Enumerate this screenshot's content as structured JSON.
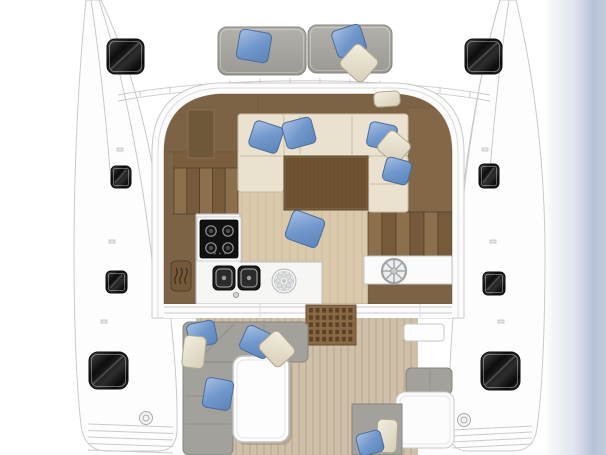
{
  "image": {
    "kind": "catamaran-deck-floor-plan",
    "view": "top-down",
    "visible_text": "none"
  },
  "palette": {
    "bg": "#ffffff",
    "line": "#c7cacd",
    "line2": "#d9dbdd",
    "hull": "#fdfdfe",
    "floor": "#dbc9ab",
    "floor-line": "#b9a888",
    "teak": "#cec0a9",
    "teak-line": "#b2a186",
    "wood": "#7d6345",
    "wood-deep": "#6f5739",
    "wood-edge": "#5f4a33",
    "table-wood": "#6f5333",
    "cream": "#eae2cf",
    "cream-line": "#c6bda3",
    "sofa-gray": "#a3a19c",
    "sofa-edge": "#87857f",
    "pad-gray": "#a9a7a2",
    "counter": "#f6f6f4",
    "counter-edge": "#b9bcbe",
    "pillow-blue": "#7da1d4",
    "pillow-cream": "#e9e3d2",
    "water-edge": "#b6c1d7",
    "hatch-dark": "#0d0d0d"
  },
  "foredeck": {
    "tick_count": 12,
    "sunpads": [
      {
        "x": 218,
        "y": 27,
        "w": 88,
        "h": 48
      },
      {
        "x": 308,
        "y": 25,
        "w": 84,
        "h": 48
      }
    ]
  },
  "deck_hatches": [
    {
      "x": 107,
      "y": 39,
      "w": 37,
      "h": 35,
      "r": 8
    },
    {
      "x": 111,
      "y": 166,
      "w": 20,
      "h": 22,
      "r": 5
    },
    {
      "x": 106,
      "y": 271,
      "w": 21,
      "h": 22,
      "r": 5
    },
    {
      "x": 89,
      "y": 352,
      "w": 39,
      "h": 37,
      "r": 9
    },
    {
      "x": 465,
      "y": 39,
      "w": 37,
      "h": 35,
      "r": 8
    },
    {
      "x": 479,
      "y": 164,
      "w": 20,
      "h": 24,
      "r": 5
    },
    {
      "x": 483,
      "y": 272,
      "w": 22,
      "h": 23,
      "r": 5
    },
    {
      "x": 481,
      "y": 352,
      "w": 39,
      "h": 38,
      "r": 9
    }
  ],
  "pillows": [
    {
      "cx": 254,
      "cy": 46,
      "w": 32,
      "h": 30,
      "rot": 10,
      "color": "blue"
    },
    {
      "cx": 349,
      "cy": 41,
      "w": 30,
      "h": 28,
      "rot": -18,
      "color": "blue"
    },
    {
      "cx": 359,
      "cy": 63,
      "w": 30,
      "h": 29,
      "rot": 42,
      "color": "cream"
    },
    {
      "cx": 266,
      "cy": 137,
      "w": 30,
      "h": 27,
      "rot": 18,
      "color": "blue"
    },
    {
      "cx": 299,
      "cy": 133,
      "w": 30,
      "h": 27,
      "rot": -15,
      "color": "blue"
    },
    {
      "cx": 387,
      "cy": 99,
      "w": 26,
      "h": 15,
      "rot": -4,
      "color": "cream"
    },
    {
      "cx": 382,
      "cy": 136,
      "w": 28,
      "h": 25,
      "rot": 12,
      "color": "blue"
    },
    {
      "cx": 394,
      "cy": 147,
      "w": 27,
      "h": 25,
      "rot": 40,
      "color": "cream"
    },
    {
      "cx": 397,
      "cy": 171,
      "w": 26,
      "h": 24,
      "rot": 15,
      "color": "blue"
    },
    {
      "cx": 305,
      "cy": 229,
      "w": 34,
      "h": 30,
      "rot": 20,
      "color": "blue"
    },
    {
      "cx": 202,
      "cy": 334,
      "w": 28,
      "h": 24,
      "rot": -12,
      "color": "blue"
    },
    {
      "cx": 194,
      "cy": 352,
      "w": 22,
      "h": 32,
      "rot": 6,
      "color": "cream"
    },
    {
      "cx": 257,
      "cy": 342,
      "w": 30,
      "h": 26,
      "rot": 25,
      "color": "blue"
    },
    {
      "cx": 277,
      "cy": 349,
      "w": 30,
      "h": 26,
      "rot": 48,
      "color": "cream"
    },
    {
      "cx": 218,
      "cy": 394,
      "w": 28,
      "h": 30,
      "rot": 10,
      "color": "blue"
    },
    {
      "cx": 387,
      "cy": 436,
      "w": 20,
      "h": 33,
      "rot": 3,
      "color": "cream"
    },
    {
      "cx": 370,
      "cy": 443,
      "w": 25,
      "h": 22,
      "rot": -15,
      "color": "blue"
    }
  ],
  "stairs": [
    {
      "x": 174,
      "y": 168,
      "w": 64,
      "h": 46,
      "steps": 5
    },
    {
      "x": 368,
      "y": 212,
      "w": 84,
      "h": 44,
      "steps": 6
    }
  ],
  "saloon_table": {
    "x": 284,
    "y": 156,
    "w": 84,
    "h": 54,
    "grain_spacing": 4
  },
  "cockpit_table": {
    "x": 233,
    "y": 356,
    "w": 56,
    "h": 86
  },
  "galley": {
    "hob": {
      "x": 200,
      "y": 220,
      "w": 38,
      "h": 38
    },
    "burners": [
      [
        211,
        231
      ],
      [
        228,
        231
      ],
      [
        211,
        248
      ],
      [
        228,
        248
      ]
    ],
    "knob_dots": [
      [
        215,
        253.5
      ],
      [
        220,
        253.5
      ],
      [
        225,
        253.5
      ]
    ],
    "sinks": [
      {
        "x": 213,
        "y": 266,
        "w": 22,
        "h": 24
      },
      {
        "x": 238,
        "y": 266,
        "w": 22,
        "h": 24
      }
    ],
    "faucet": [
      236,
      295
    ],
    "fan": {
      "cx": 284,
      "cy": 281,
      "r": 12,
      "petals": 8
    },
    "heater_icon": {
      "x": 171,
      "y": 261,
      "w": 20,
      "h": 30,
      "waves": 3
    }
  },
  "helm": {
    "panel": {
      "x": 364,
      "y": 256,
      "w": 88,
      "h": 28
    },
    "wheel": {
      "cx": 394,
      "cy": 271,
      "r": 12,
      "spokes": 8
    }
  },
  "grating": {
    "x": 306,
    "y": 305,
    "w": 50,
    "h": 40,
    "cols": 7,
    "rows": 5
  },
  "planks": {
    "saloon": {
      "x": 174,
      "y": 114,
      "w": 278,
      "h": 190,
      "spacing": 8
    },
    "cockpit": {
      "x": 196,
      "y": 318,
      "w": 222,
      "h": 137,
      "spacing": 7
    }
  },
  "transom_steps": {
    "port": {
      "x1": 88,
      "x2": 173,
      "y": 424,
      "n": 5,
      "dy": 6.5,
      "slope": 3
    },
    "starboard": {
      "x1": 452,
      "x2": 532,
      "y": 430,
      "n": 4,
      "dy": 6,
      "slope": -4
    }
  },
  "deck_fittings": [
    [
      146,
      418
    ],
    [
      464,
      420
    ]
  ],
  "icons": [
    "ships-wheel-icon",
    "stove-burner-icon",
    "sink-icon",
    "oven-steam-icon",
    "vent-fan-icon",
    "deck-hatch-icon"
  ]
}
